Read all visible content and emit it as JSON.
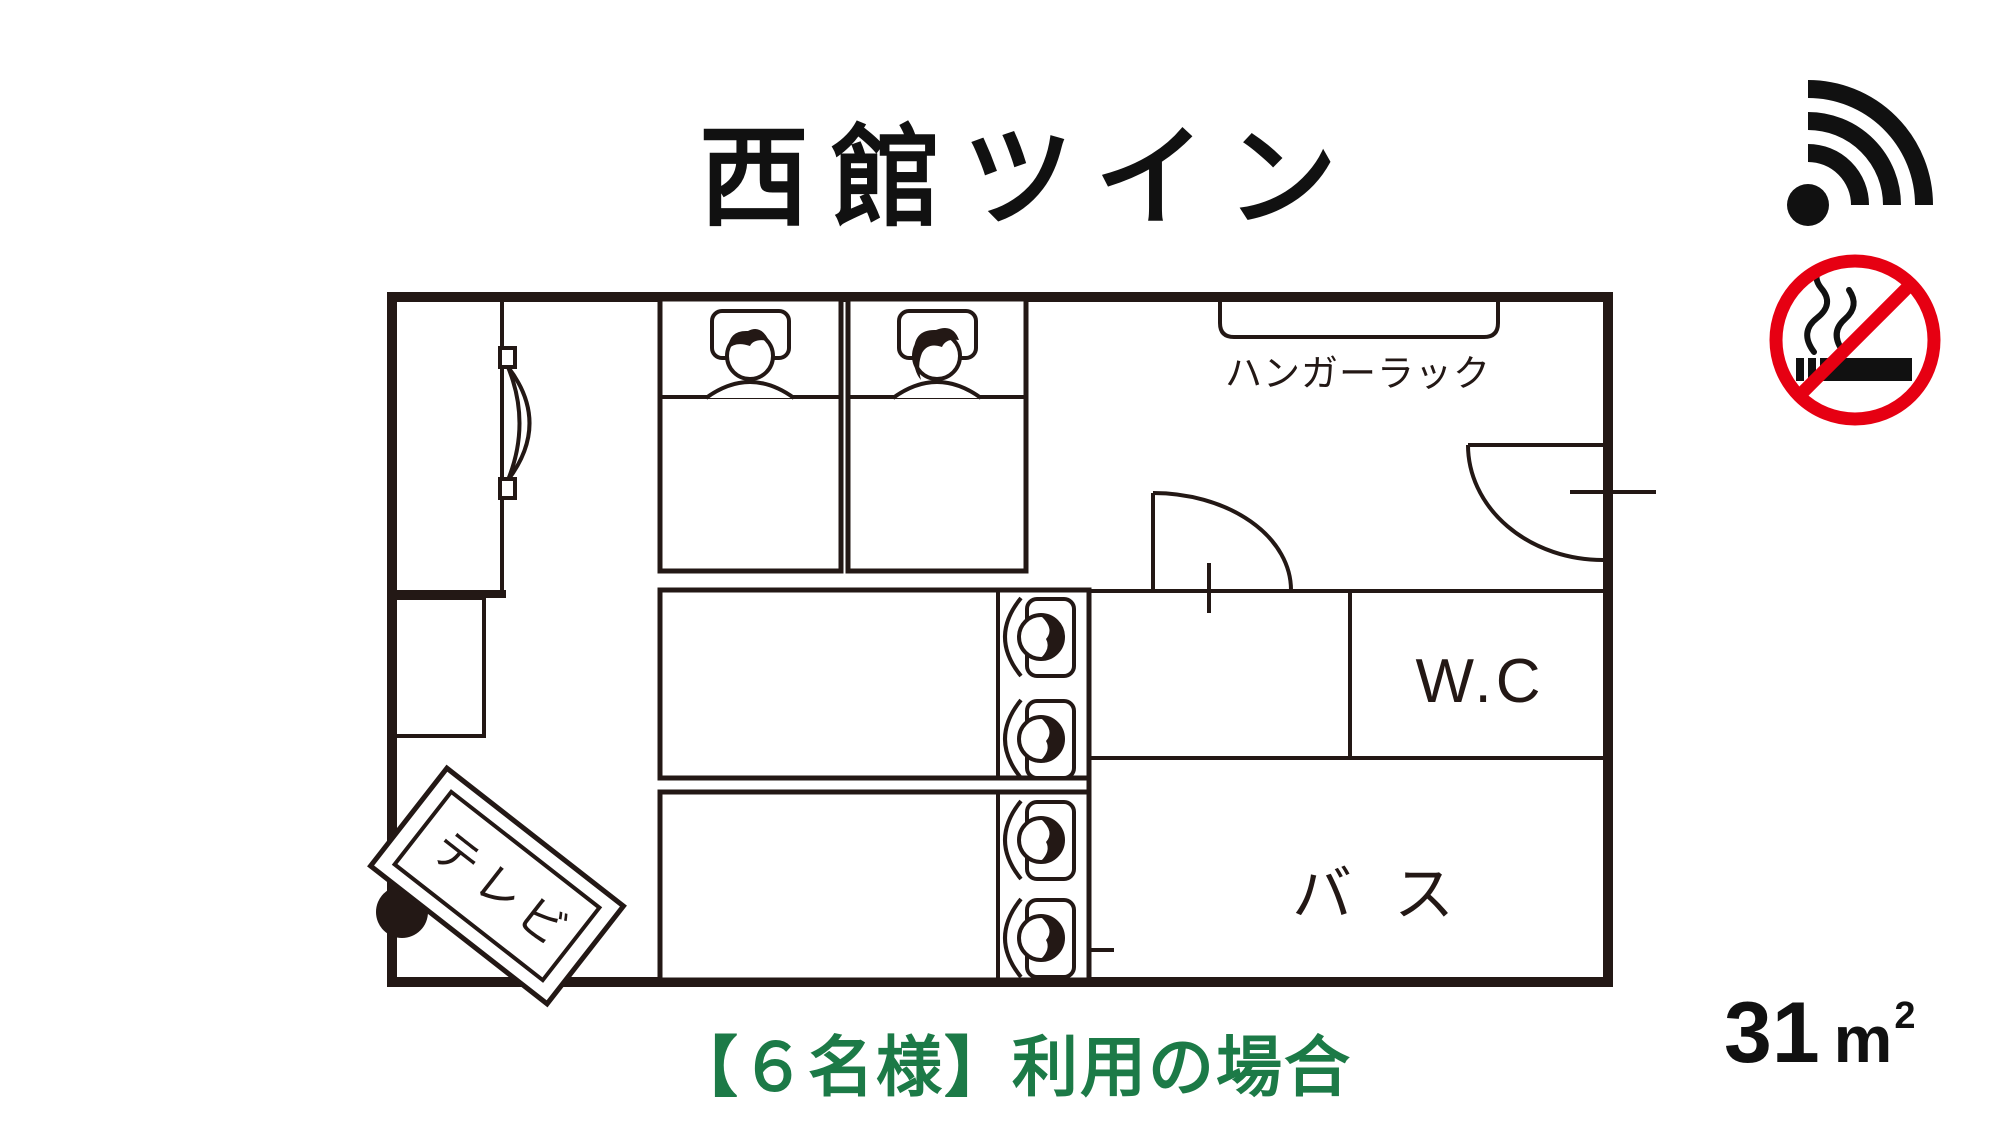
{
  "title": "西館ツイン",
  "plan": {
    "labels": {
      "hanger_rack": "ハンガーラック",
      "wc": "W.C",
      "bath": "バス",
      "tv": "テレビ"
    }
  },
  "caption": "【６名様】利用の場合",
  "area": {
    "value": "31",
    "unit": "m",
    "exponent": "2"
  },
  "icons": {
    "wifi": "wifi-icon",
    "no_smoking": "no-smoking-icon"
  },
  "colors": {
    "line": "#231815",
    "caption_green": "#1c7a47",
    "no_smoking_red": "#e60012"
  }
}
